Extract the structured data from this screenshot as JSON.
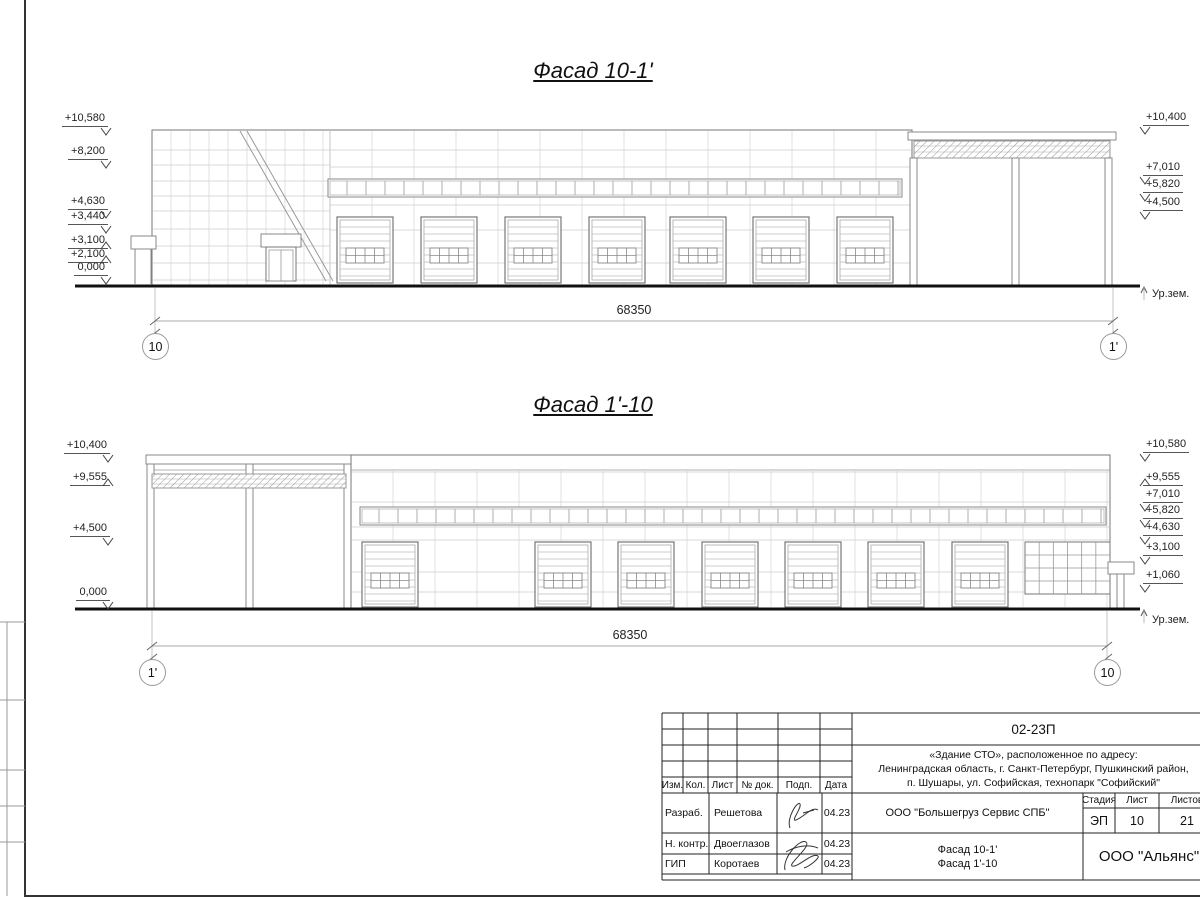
{
  "facades": [
    {
      "title": "Фасад 10-1'",
      "dimension": "68350",
      "axis_left": "10",
      "axis_right": "1'",
      "ground_label": "Ур.зем.",
      "marks_left": [
        "+10,580",
        "+8,200",
        "+4,630",
        "+3,440",
        "+3,100",
        "+2,100",
        "0,000"
      ],
      "marks_right": [
        "+10,400",
        "+7,010",
        "+5,820",
        "+4,500"
      ]
    },
    {
      "title": "Фасад 1'-10",
      "dimension": "68350",
      "axis_left": "1'",
      "axis_right": "10",
      "ground_label": "Ур.зем.",
      "marks_left": [
        "+10,400",
        "+9,555",
        "+4,500",
        "0,000"
      ],
      "marks_right": [
        "+10,580",
        "+9,555",
        "+7,010",
        "+5,820",
        "+4,630",
        "+3,100",
        "+1,060"
      ]
    }
  ],
  "title_block": {
    "doc_number": "02-23П",
    "address_lines": [
      "«Здание СТО», расположенное по адресу:",
      "Ленинградская область, г. Санкт-Петербург, Пушкинский район,",
      "п. Шушары, ул. Софийская, технопарк \"Софийский\""
    ],
    "columns": [
      "Изм.",
      "Кол.",
      "Лист",
      "№ док.",
      "Подп.",
      "Дата"
    ],
    "rows": [
      {
        "role": "Разраб.",
        "name": "Решетова",
        "date": "04.23"
      },
      {
        "role": "Н. контр.",
        "name": "Двоеглазов",
        "date": "04.23"
      },
      {
        "role": "ГИП",
        "name": "Коротаев",
        "date": "04.23"
      }
    ],
    "company": "ООО \"Большегруз Сервис СПБ\"",
    "stage_label": "Стадия",
    "sheet_label": "Лист",
    "sheets_label": "Листов",
    "stage": "ЭП",
    "sheet_no": "10",
    "sheets_total": "21",
    "drawing_titles": [
      "Фасад 10-1'",
      "Фасад 1'-10"
    ],
    "org": "ООО \"Альянс\""
  }
}
